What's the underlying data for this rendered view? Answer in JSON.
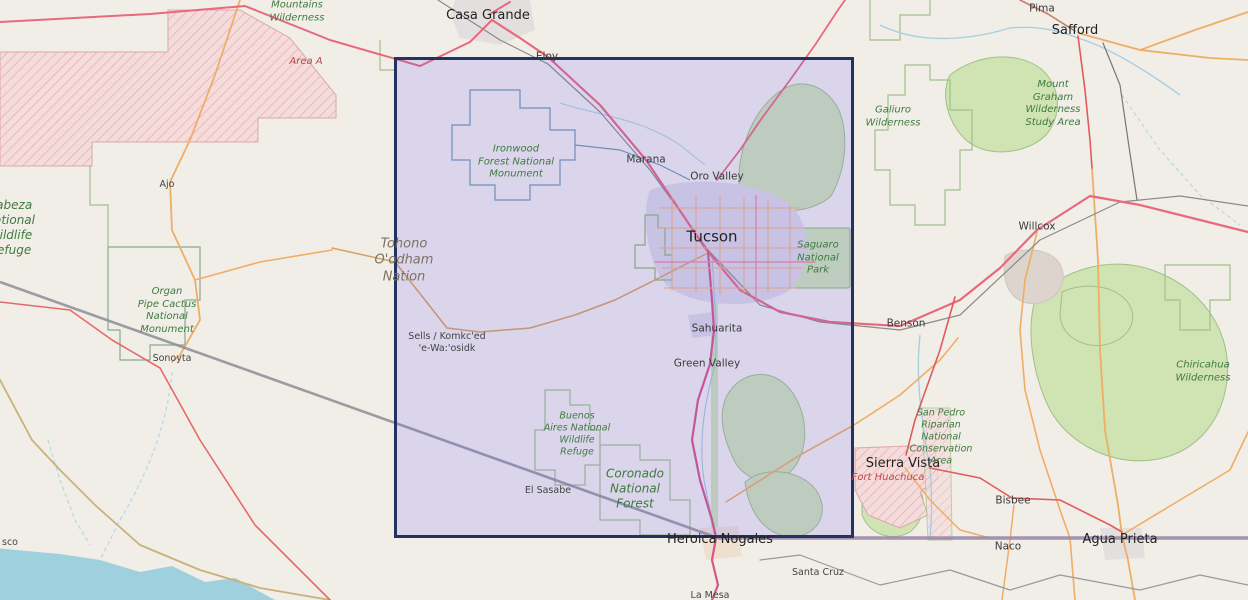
{
  "map": {
    "style": "openstreetmap-carto",
    "region": "Southern Arizona / Sonora border",
    "colors": {
      "background": "#f1eee8",
      "selection_fill": "rgba(100,90,250,0.16)",
      "selection_border": "#22335f",
      "motorway_road": "#e8697d",
      "secondary_road": "#f0ad66",
      "park_label": "#3f7a3f",
      "military_area": "#f3d9d9",
      "water": "#9fd0dd",
      "international_border": "#9b87a8"
    }
  },
  "labels": {
    "casa_grande": {
      "text": "Casa Grande"
    },
    "eloy": {
      "text": "Eloy"
    },
    "marana": {
      "text": "Marana"
    },
    "oro_valley": {
      "text": "Oro Valley"
    },
    "tucson": {
      "text": "Tucson"
    },
    "sahuarita": {
      "text": "Sahuarita"
    },
    "green_valley": {
      "text": "Green Valley"
    },
    "benson": {
      "text": "Benson"
    },
    "willcox": {
      "text": "Willcox"
    },
    "pima": {
      "text": "Pima"
    },
    "safford": {
      "text": "Safford"
    },
    "sierra_vista": {
      "text": "Sierra Vista"
    },
    "bisbee": {
      "text": "Bisbee"
    },
    "naco": {
      "text": "Naco"
    },
    "agua_prieta": {
      "text": "Agua Prieta"
    },
    "heroica_nogales": {
      "text": "Heroica Nogales"
    },
    "santa_cruz": {
      "text": "Santa Cruz"
    },
    "la_mesa": {
      "text": "La Mesa"
    },
    "sonoyta": {
      "text": "Sonoyta"
    },
    "ajo": {
      "text": "Ajo"
    },
    "el_sasabe": {
      "text": "El Sasabe"
    },
    "penasco_partial": {
      "text": "sco"
    },
    "sells": {
      "text": "Sells / Komkc'ed\n'e-Wa:'osidk"
    },
    "tohono_oodham": {
      "text": "Tohono\nO'odham\nNation"
    },
    "ironwood": {
      "text": "Ironwood\nForest National\nMonument"
    },
    "saguaro": {
      "text": "Saguaro\nNational\nPark"
    },
    "coronado": {
      "text": "Coronado\nNational\nForest"
    },
    "buenos_aires": {
      "text": "Buenos\nAires National\nWildlife\nRefuge"
    },
    "organ_pipe": {
      "text": "Organ\nPipe Cactus\nNational\nMonument"
    },
    "cabeza": {
      "text": "Cabeza\nNational\nWildlife\nRefuge"
    },
    "mountains_wilderness": {
      "text": "Mountains\nWilderness"
    },
    "galiuro": {
      "text": "Galiuro\nWilderness"
    },
    "mount_graham": {
      "text": "Mount\nGraham\nWilderness\nStudy Area"
    },
    "san_pedro": {
      "text": "San Pedro\nRiparian\nNational\nConservation\nArea"
    },
    "chiricahua": {
      "text": "Chiricahua\nWilderness"
    },
    "area_a": {
      "text": "Area A"
    },
    "fort_huachuca": {
      "text": "Fort Huachuca"
    }
  }
}
